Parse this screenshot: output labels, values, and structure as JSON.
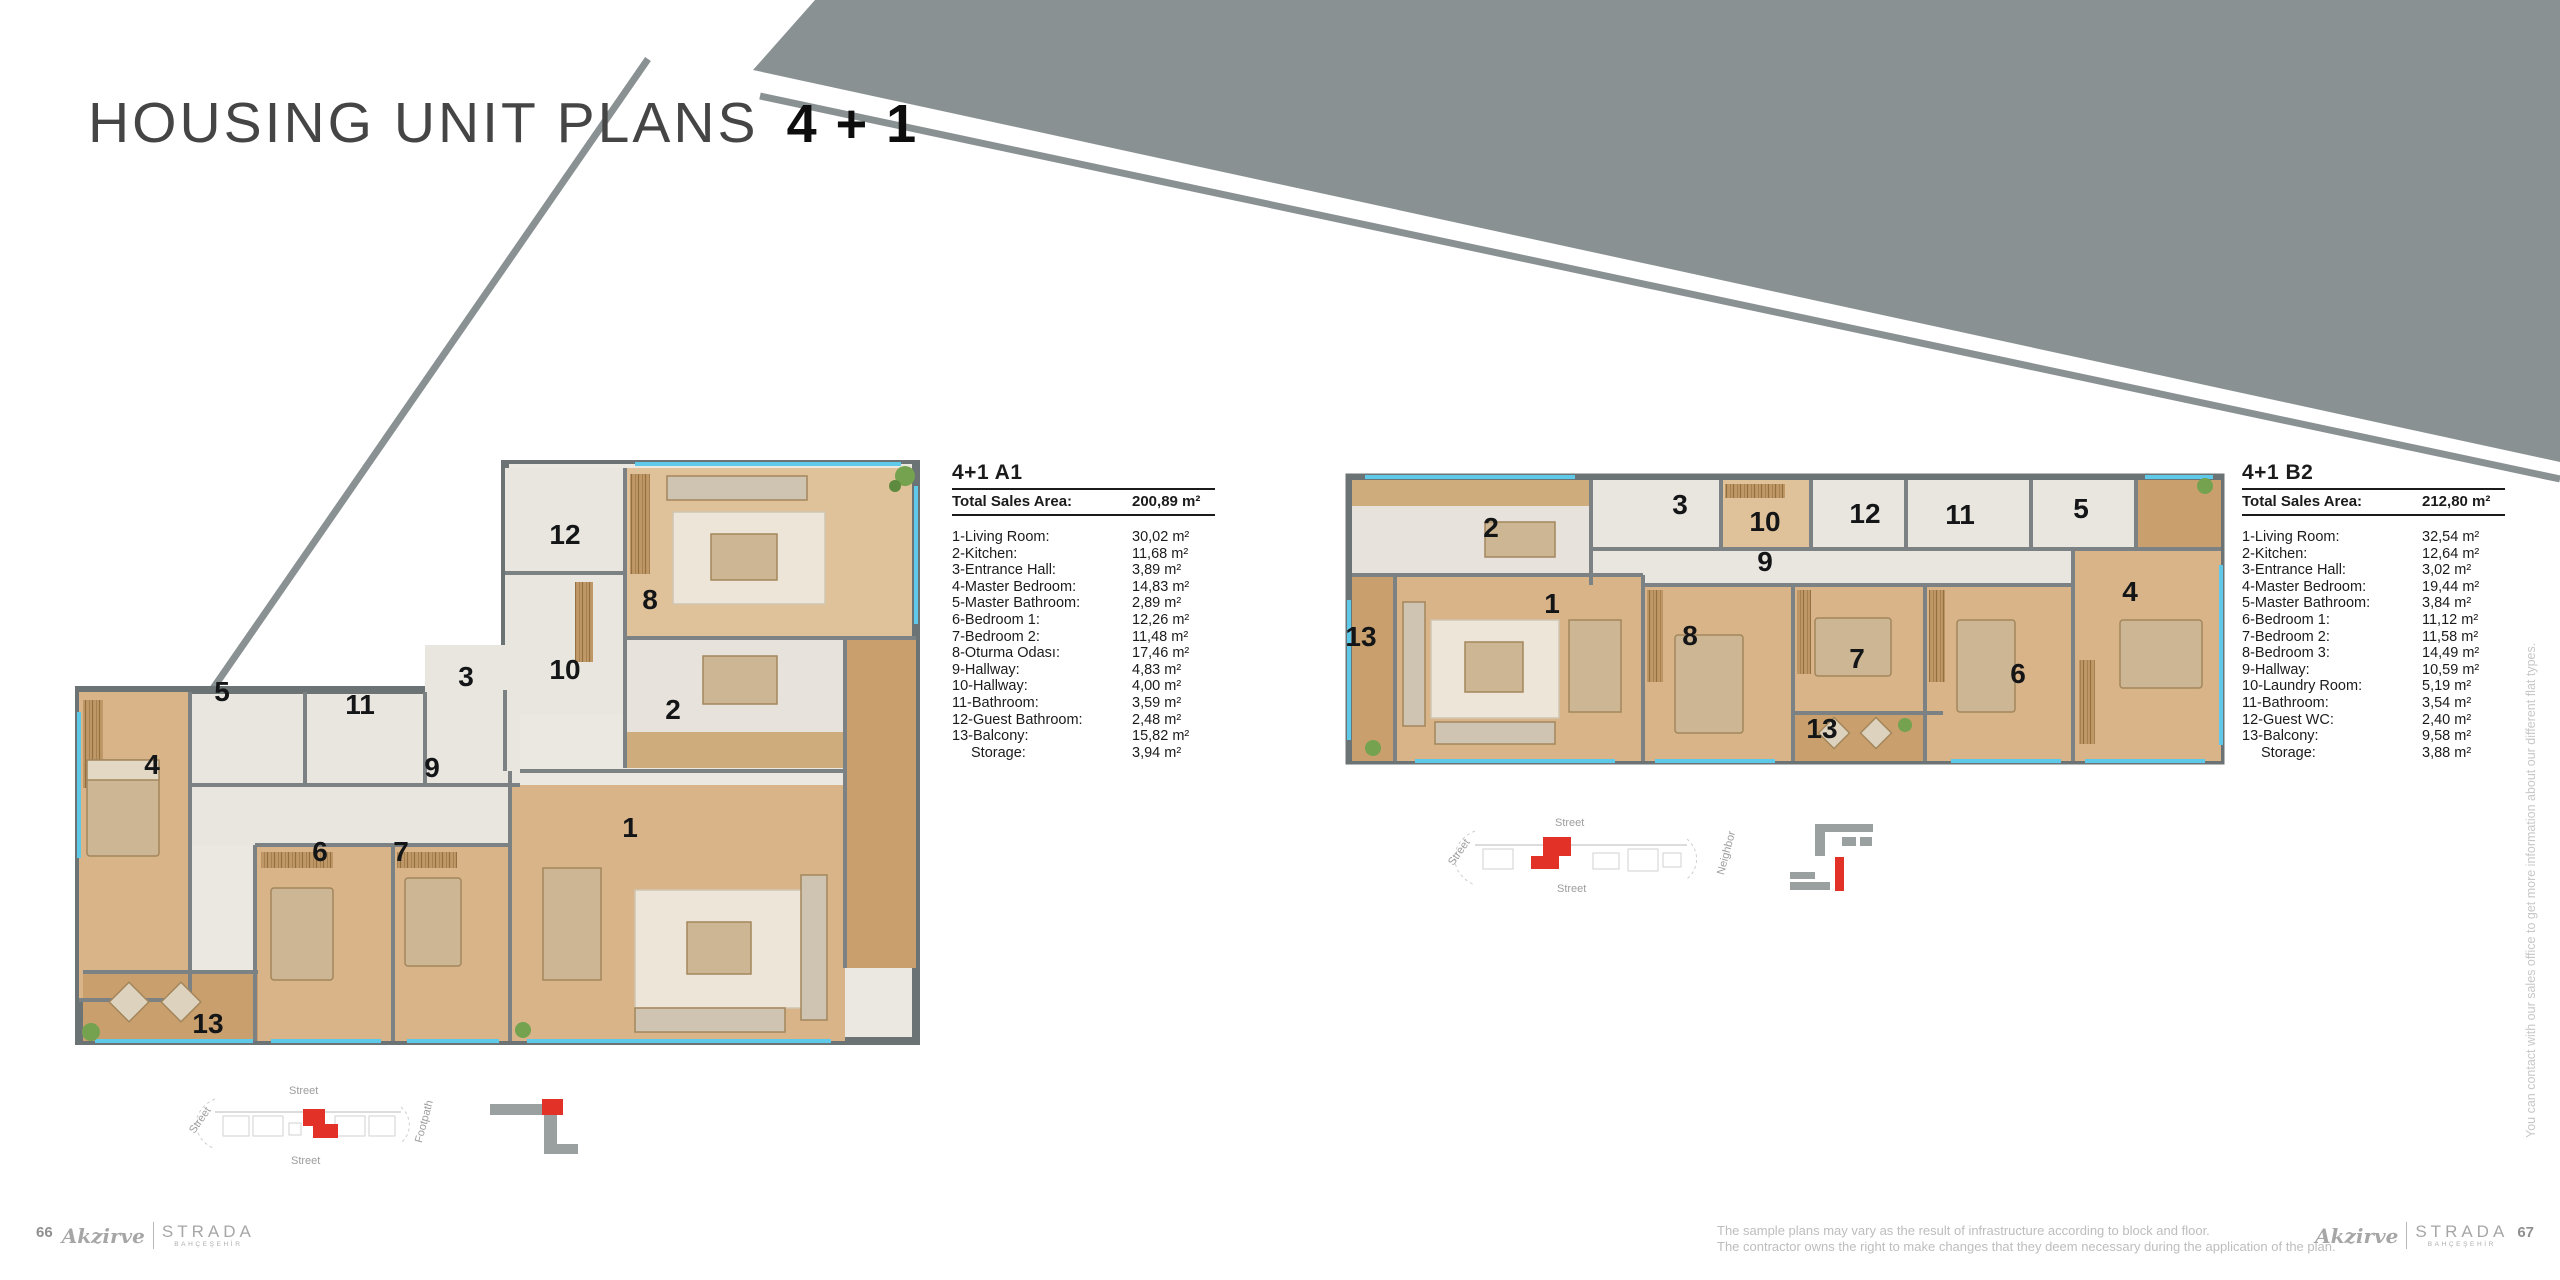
{
  "header": {
    "title": "HOUSING UNIT PLANS",
    "suffix": "4 + 1"
  },
  "side_note": "You can contact with our sales office to get more information about our different flat types.",
  "colors": {
    "accent_red": "#e23227",
    "decor_gray": "#8a9192",
    "wood": "#d8b488",
    "window_cyan": "#5fc9e9"
  },
  "footer": {
    "page_left": "66",
    "page_right": "67",
    "brand_script": "Akzirve",
    "brand_name": "STRADA",
    "brand_sub": "BAHÇEŞEHİR",
    "disclaimer1": "The sample plans may vary as the result of infrastructure according to block and floor.",
    "disclaimer2": "The contractor owns the right to make changes that they deem necessary during the application of the plan."
  },
  "plans": [
    {
      "id": "A1",
      "title": "4+1 A1",
      "total_label": "Total Sales Area:",
      "total_value": "200,89 m²",
      "rooms": [
        {
          "label": "1-Living Room:",
          "value": "30,02 m²"
        },
        {
          "label": "2-Kitchen:",
          "value": "11,68 m²"
        },
        {
          "label": "3-Entrance Hall:",
          "value": "3,89 m²"
        },
        {
          "label": "4-Master Bedroom:",
          "value": "14,83 m²"
        },
        {
          "label": "5-Master Bathroom:",
          "value": "2,89 m²"
        },
        {
          "label": "6-Bedroom 1:",
          "value": "12,26 m²"
        },
        {
          "label": "7-Bedroom 2:",
          "value": "11,48 m²"
        },
        {
          "label": "8-Oturma Odası:",
          "value": "17,46 m²"
        },
        {
          "label": "9-Hallway:",
          "value": "4,83 m²"
        },
        {
          "label": "10-Hallway:",
          "value": "4,00 m²"
        },
        {
          "label": "11-Bathroom:",
          "value": "3,59 m²"
        },
        {
          "label": "12-Guest Bathroom:",
          "value": "2,48 m²"
        },
        {
          "label": "13-Balcony:",
          "value": "15,82 m²"
        },
        {
          "label": "Storage:",
          "value": "3,94 m²",
          "indent": true
        }
      ],
      "floor_labels": [
        {
          "t": "12",
          "x": 490,
          "y": 75
        },
        {
          "t": "8",
          "x": 575,
          "y": 140
        },
        {
          "t": "10",
          "x": 490,
          "y": 210
        },
        {
          "t": "3",
          "x": 391,
          "y": 217
        },
        {
          "t": "2",
          "x": 598,
          "y": 250
        },
        {
          "t": "5",
          "x": 147,
          "y": 232
        },
        {
          "t": "11",
          "x": 285,
          "y": 245
        },
        {
          "t": "9",
          "x": 357,
          "y": 308
        },
        {
          "t": "4",
          "x": 77,
          "y": 305
        },
        {
          "t": "6",
          "x": 245,
          "y": 392
        },
        {
          "t": "7",
          "x": 326,
          "y": 392
        },
        {
          "t": "1",
          "x": 555,
          "y": 368
        },
        {
          "t": "13",
          "x": 133,
          "y": 564
        }
      ],
      "site": {
        "top": "Street",
        "bottom": "Street",
        "left": "Street",
        "right": "Footpath"
      }
    },
    {
      "id": "B2",
      "title": "4+1 B2",
      "total_label": "Total Sales Area:",
      "total_value": "212,80 m²",
      "rooms": [
        {
          "label": "1-Living Room:",
          "value": "32,54 m²"
        },
        {
          "label": "2-Kitchen:",
          "value": "12,64 m²"
        },
        {
          "label": "3-Entrance Hall:",
          "value": "3,02 m²"
        },
        {
          "label": "4-Master Bedroom:",
          "value": "19,44 m²"
        },
        {
          "label": "5-Master Bathroom:",
          "value": "3,84 m²"
        },
        {
          "label": "6-Bedroom 1:",
          "value": "11,12 m²"
        },
        {
          "label": "7-Bedroom 2:",
          "value": "11,58 m²"
        },
        {
          "label": "8-Bedroom 3:",
          "value": "14,49 m²"
        },
        {
          "label": "9-Hallway:",
          "value": "10,59 m²"
        },
        {
          "label": "10-Laundry Room:",
          "value": "5,19 m²"
        },
        {
          "label": "11-Bathroom:",
          "value": "3,54 m²"
        },
        {
          "label": "12-Guest WC:",
          "value": "2,40 m²"
        },
        {
          "label": "13-Balcony:",
          "value": "9,58 m²"
        },
        {
          "label": "Storage:",
          "value": "3,88 m²",
          "indent": true
        }
      ],
      "floor_labels": [
        {
          "t": "2",
          "x": 146,
          "y": 58
        },
        {
          "t": "3",
          "x": 335,
          "y": 35
        },
        {
          "t": "10",
          "x": 420,
          "y": 52
        },
        {
          "t": "12",
          "x": 520,
          "y": 44
        },
        {
          "t": "11",
          "x": 615,
          "y": 45
        },
        {
          "t": "5",
          "x": 736,
          "y": 39
        },
        {
          "t": "9",
          "x": 420,
          "y": 92
        },
        {
          "t": "13",
          "x": 16,
          "y": 167
        },
        {
          "t": "1",
          "x": 207,
          "y": 134
        },
        {
          "t": "8",
          "x": 345,
          "y": 166
        },
        {
          "t": "7",
          "x": 512,
          "y": 189
        },
        {
          "t": "6",
          "x": 673,
          "y": 204
        },
        {
          "t": "4",
          "x": 785,
          "y": 122
        },
        {
          "t": "13",
          "x": 477,
          "y": 259
        }
      ],
      "site": {
        "top": "Street",
        "bottom": "Street",
        "left": "Street",
        "right": "Neighbor"
      }
    }
  ]
}
